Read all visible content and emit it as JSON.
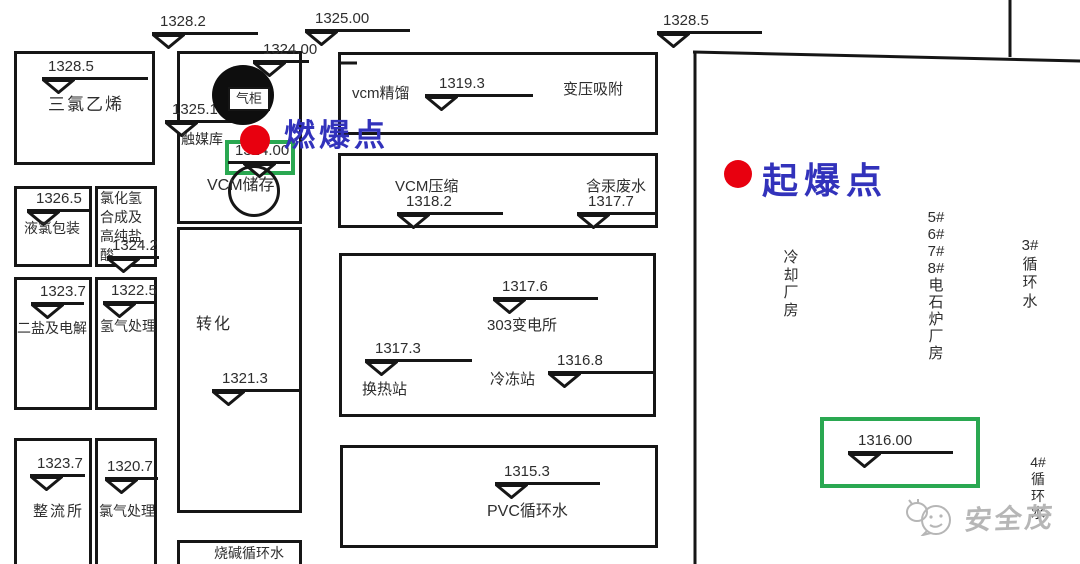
{
  "palette": {
    "ink": "#161616",
    "highlight_green": "#2aa851",
    "point_red": "#e8000f",
    "point_label_blue": "#3232bb",
    "watermark_gray": "#b6b6b6"
  },
  "annotations": {
    "ignition": {
      "label": "燃爆点"
    },
    "detonation": {
      "label": "起爆点"
    }
  },
  "top_markers": {
    "m1328_2": {
      "value": "1328.2"
    },
    "m1325_00": {
      "value": "1325.00"
    },
    "m1324_00": {
      "value": "1324.00"
    },
    "m1328_5": {
      "value": "1328.5"
    }
  },
  "left_column": {
    "trichloroethylene": {
      "label": "三氯乙烯",
      "elevation": "1328.5"
    },
    "liquid_chlorine_packing": {
      "label": "液氯包装",
      "elevation": "1326.5"
    },
    "hcl_synthesis": {
      "label": "氯化氢合成及高纯盐酸",
      "elevation": "1324.2"
    },
    "salt_and_electrolysis": {
      "label": "二盐及电解",
      "elevation": "1323.7"
    },
    "hydrogen_treatment": {
      "label": "氢气处理",
      "elevation": "1322.5"
    },
    "rectifier_station": {
      "label": "整流所",
      "elevation": "1323.7"
    },
    "chlorine_treatment": {
      "label": "氯气处理",
      "elevation": "1320.7"
    }
  },
  "middle_column": {
    "gas_holder": {
      "label": "气柜"
    },
    "catalyst_warehouse": {
      "label": "触媒库",
      "elevation": "1325.1"
    },
    "vcm_storage": {
      "label": "VCM储存",
      "elevation": "1324.00"
    },
    "conversion": {
      "label": "转化",
      "elevation": "1321.3"
    },
    "caustic_cooling_water": {
      "label": "烧碱循环水"
    }
  },
  "center_column": {
    "vcm_distillation": {
      "label": "vcm精馏",
      "elevation": "1319.3"
    },
    "psa": {
      "label": "变压吸附"
    },
    "vcm_compression": {
      "label": "VCM压缩",
      "elevation": "1318.2"
    },
    "mercury_wastewater": {
      "label": "含汞废水",
      "elevation": "1317.7"
    },
    "substation_303": {
      "label": "303变电所",
      "elevation": "1317.6"
    },
    "heat_exchange_station": {
      "label": "换热站",
      "elevation": "1317.3"
    },
    "refrigeration_station": {
      "label": "冷冻站",
      "elevation": "1316.8"
    },
    "pvc_cooling_water": {
      "label": "PVC循环水",
      "elevation": "1315.3"
    }
  },
  "right_area": {
    "cooling_plant": {
      "chars": [
        "冷",
        "却",
        "厂",
        "房"
      ]
    },
    "carbide_furnace_plant": {
      "chars": [
        "5#",
        "6#",
        "7#",
        "8#",
        "电",
        "石",
        "炉",
        "厂",
        "房"
      ]
    },
    "cooling_water_3": {
      "chars": [
        "3#",
        "循",
        "环",
        "水"
      ]
    },
    "cooling_water_4": {
      "chars": [
        "4#",
        "循",
        "环",
        "水"
      ]
    },
    "highlight_elevation": {
      "value": "1316.00"
    }
  },
  "watermark": {
    "text": "安全茂"
  }
}
